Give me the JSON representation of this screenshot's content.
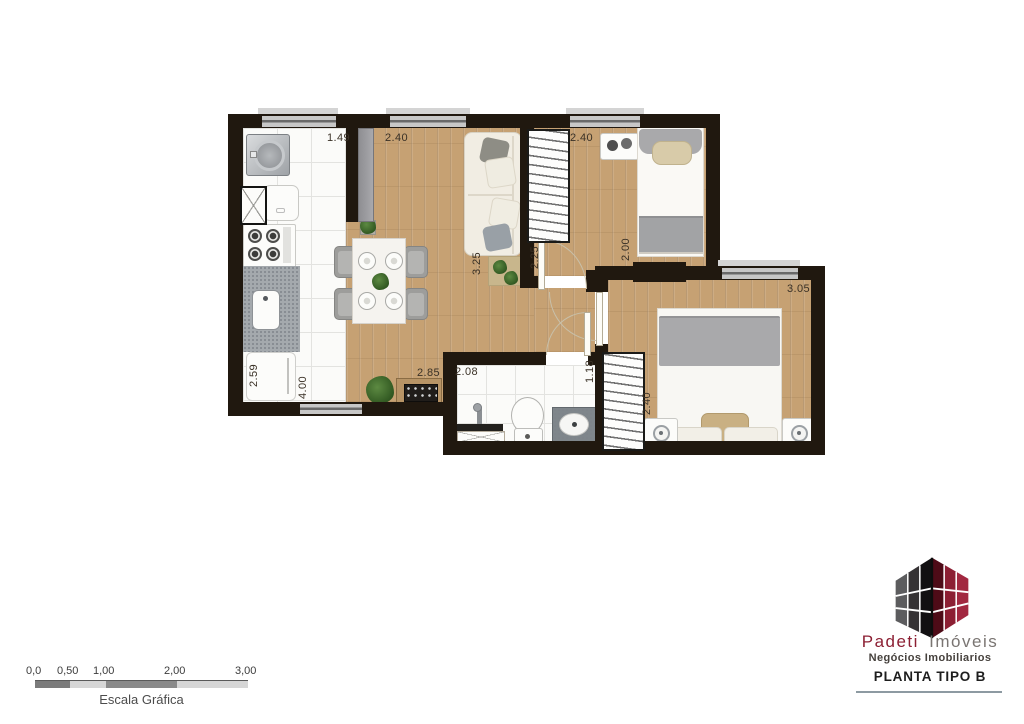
{
  "colors": {
    "wall": "#20180f",
    "wood": "#c6a173",
    "brand_red": "#8c1f33",
    "brand_gray": "#7a7572"
  },
  "dims": {
    "kitchen_width": "1.49",
    "living_width": "2.40",
    "bedroom2_width": "2.40",
    "living_length": "3.25",
    "bedroom2_side": "2.25",
    "bedroom2_length": "2.00",
    "bedroom1_width": "3.05",
    "bedroom1_length": "2.40",
    "kitchen_length": "2.59",
    "living_side": "4.00",
    "living_bottom": "2.85",
    "bathroom_width": "2.08",
    "hall_width": "1.18"
  },
  "scalebar": {
    "ticks": [
      "0,0",
      "0,50",
      "1,00",
      "2,00",
      "3,00"
    ],
    "label": "Escala Gráfica"
  },
  "brand": {
    "name_red": "Padeti",
    "name_gray": "Imóveis",
    "tagline": "Negócios Imobiliarios",
    "plan_label": "PLANTA TIPO B"
  }
}
